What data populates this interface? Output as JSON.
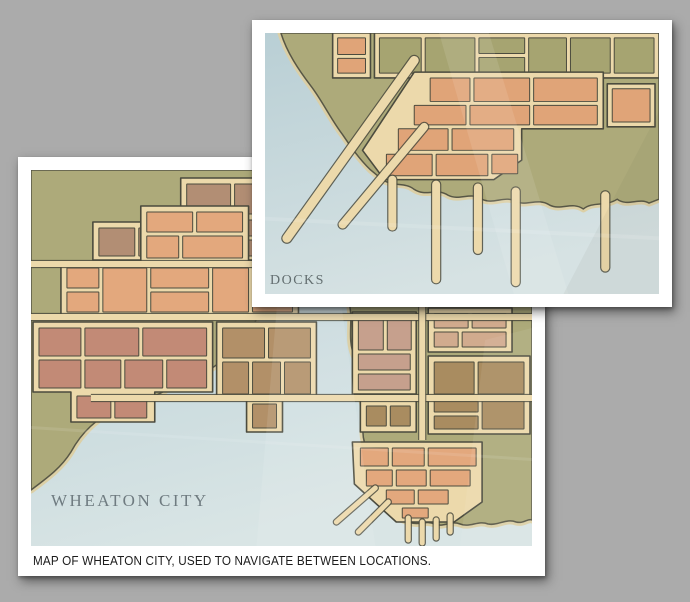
{
  "background_color": "#ababab",
  "palette": {
    "street": "#ecd9ab",
    "sand_halo": "#dccfa2",
    "outline": "#4b4b3e",
    "land": "#adaa7a"
  },
  "cards": {
    "wheaton": {
      "label": "WHEATON CITY",
      "caption": "MAP OF WHEATON CITY, USED TO NAVIGATE BETWEEN LOCATIONS."
    },
    "docks": {
      "label": "DOCKS"
    }
  },
  "maps": {
    "wheaton": {
      "id": "wheaton",
      "viewBox": "0 0 502 376",
      "water_top": "#b7ced5",
      "water_bottom": "#d9e5e5",
      "land": [
        "M0,0 L247,0 C240,20 246,42 236,62 C242,84 230,104 234,126 C228,146 222,160 212,172 C200,186 186,194 174,204 C158,214 146,212 132,222 C114,232 96,230 82,240 C66,250 52,260 40,282 C30,298 16,308 0,320 Z",
        "M314,0 C320,22 312,44 322,66 C314,88 326,108 318,130 C324,150 316,168 324,186 C330,202 326,216 332,232 C336,248 330,258 334,272 C338,290 330,300 338,314 C346,330 358,340 368,348 L378,352 C390,356 396,350 404,354 C414,358 420,350 430,354 C440,358 448,350 458,354 C468,356 476,348 486,352 C494,354 498,348 502,350 L502,0 Z"
      ],
      "districts": [
        {
          "color": "#b28e74",
          "underlay": "M62,52 L150,52 L150,8 L306,8 L306,90 L62,90 Z",
          "blocks": [
            [
              156,
              14,
              44,
              30
            ],
            [
              204,
              14,
              50,
              30
            ],
            [
              258,
              14,
              42,
              30
            ],
            [
              156,
              50,
              32,
              36
            ],
            [
              192,
              50,
              46,
              16
            ],
            [
              192,
              70,
              46,
              16
            ],
            [
              242,
              50,
              28,
              36
            ],
            [
              274,
              50,
              26,
              36
            ],
            [
              68,
              58,
              36,
              28
            ],
            [
              108,
              58,
              38,
              28
            ]
          ]
        },
        {
          "color": "#e3a87d",
          "underlay": "M110,36 L218,36 L218,92 L268,92 L268,148 L30,148 L30,92 L110,92 Z",
          "blocks": [
            [
              116,
              42,
              46,
              20
            ],
            [
              166,
              42,
              46,
              20
            ],
            [
              116,
              66,
              32,
              22
            ],
            [
              152,
              66,
              60,
              22
            ],
            [
              36,
              98,
              32,
              20
            ],
            [
              36,
              122,
              32,
              20
            ],
            [
              72,
              98,
              44,
              44
            ],
            [
              120,
              98,
              58,
              20
            ],
            [
              120,
              122,
              58,
              20
            ],
            [
              182,
              98,
              36,
              44
            ],
            [
              222,
              98,
              40,
              20
            ],
            [
              222,
              122,
              40,
              20
            ]
          ]
        },
        {
          "color": "#c28a76",
          "underlay": "M2,152 L182,152 L182,222 L124,222 L124,252 L40,252 L40,222 L2,222 Z",
          "blocks": [
            [
              8,
              158,
              42,
              28
            ],
            [
              54,
              158,
              54,
              28
            ],
            [
              112,
              158,
              64,
              28
            ],
            [
              8,
              190,
              42,
              28
            ],
            [
              54,
              190,
              36,
              28
            ],
            [
              94,
              190,
              38,
              28
            ],
            [
              136,
              190,
              40,
              28
            ],
            [
              46,
              226,
              34,
              22
            ],
            [
              84,
              226,
              32,
              22
            ]
          ]
        },
        {
          "color": "#b29068",
          "underlay": "M186,152 L286,152 L286,230 L252,230 L252,262 L216,262 L216,230 L186,230 Z",
          "blocks": [
            [
              192,
              158,
              42,
              30
            ],
            [
              238,
              158,
              42,
              30
            ],
            [
              192,
              192,
              26,
              32
            ],
            [
              222,
              192,
              28,
              32
            ],
            [
              254,
              192,
              26,
              32
            ],
            [
              222,
              234,
              24,
              24
            ]
          ]
        },
        {
          "color": "#c6a08d",
          "underlay": "M322,142 L386,142 L386,224 L322,224 Z",
          "blocks": [
            [
              328,
              148,
              25,
              32
            ],
            [
              357,
              148,
              24,
              32
            ],
            [
              328,
              184,
              52,
              16
            ],
            [
              328,
              204,
              52,
              16
            ]
          ]
        },
        {
          "color": "#d1ab8e",
          "underlay": "M398,138 L482,138 L482,182 L398,182 Z",
          "blocks": [
            [
              404,
              144,
              34,
              14
            ],
            [
              442,
              144,
              34,
              14
            ],
            [
              404,
              162,
              24,
              15
            ],
            [
              432,
              162,
              44,
              15
            ]
          ]
        },
        {
          "color": "#a98c60",
          "underlay": "M398,186 L500,186 L500,264 L398,264 Z",
          "blocks": [
            [
              404,
              192,
              40,
              32
            ],
            [
              448,
              192,
              46,
              32
            ],
            [
              404,
              228,
              44,
              14
            ],
            [
              404,
              246,
              44,
              13
            ],
            [
              452,
              228,
              42,
              31
            ]
          ]
        },
        {
          "color": "#a98c60",
          "underlay": "M330,230 L386,230 L386,262 L330,262 Z",
          "blocks": [
            [
              336,
              236,
              20,
              20
            ],
            [
              360,
              236,
              20,
              20
            ]
          ]
        },
        {
          "color": "#e3a87d",
          "underlay": "M322,272 L452,272 L452,332 L424,352 L366,352 L324,314 Z",
          "blocks": [
            [
              330,
              278,
              28,
              18
            ],
            [
              362,
              278,
              32,
              18
            ],
            [
              398,
              278,
              48,
              18
            ],
            [
              336,
              300,
              26,
              16
            ],
            [
              366,
              300,
              30,
              16
            ],
            [
              400,
              300,
              40,
              16
            ],
            [
              356,
              320,
              28,
              14
            ],
            [
              388,
              320,
              30,
              14
            ],
            [
              372,
              338,
              26,
              10
            ]
          ]
        }
      ],
      "roads": [
        {
          "d": "M0,94 L312,94",
          "w": 6
        },
        {
          "d": "M0,147 L502,147",
          "w": 6
        },
        {
          "d": "M60,228 L502,228",
          "w": 6
        },
        {
          "d": "M392,136 L392,270",
          "w": 6
        }
      ],
      "piers": [
        {
          "d": "M345,318 L306,352",
          "w": 5
        },
        {
          "d": "M358,332 L328,362",
          "w": 5
        },
        {
          "d": "M378,348 L378,370",
          "w": 5
        },
        {
          "d": "M392,352 L392,373",
          "w": 5
        },
        {
          "d": "M406,350 L406,368",
          "w": 5
        },
        {
          "d": "M420,346 L420,362",
          "w": 5
        }
      ],
      "creases": [
        {
          "d": "M258,0 L292,0 L345,376 L226,376 Z",
          "fill": "#ffffff",
          "opacity": 0.1
        },
        {
          "d": "M455,170 L502,158 L502,376 L430,376 Z",
          "fill": "#ffffff",
          "opacity": 0.07
        },
        {
          "d": "M0,256 L502,288 L502,291 L0,259 Z",
          "fill": "#ffffff",
          "opacity": 0.1
        }
      ]
    },
    "docks": {
      "id": "docks",
      "viewBox": "0 0 396 267",
      "water_top": "#b9cfd5",
      "water_bottom": "#d6e2e3",
      "land": [
        "M16,0 C22,20 34,38 46,54 C58,70 66,88 78,104 C86,116 94,128 106,140 L118,150 C130,158 140,152 150,160 C162,168 172,158 184,166 C196,172 206,162 218,170 C230,176 240,166 252,172 C262,178 274,168 286,176 C298,182 308,172 320,180 C330,172 342,178 354,170 C364,178 376,168 386,174 L396,170 L396,0 Z"
      ],
      "districts": [
        {
          "color": "#e0a478",
          "underlay": "M68,0 L106,0 L106,46 L68,46 Z",
          "blocks": [
            [
              73,
              5,
              28,
              17
            ],
            [
              73,
              26,
              28,
              15
            ]
          ]
        },
        {
          "color": "#a6a471",
          "underlay": "M110,0 L396,0 L396,46 L110,46 Z",
          "blocks": [
            [
              115,
              5,
              42,
              36
            ],
            [
              161,
              5,
              50,
              36
            ],
            [
              215,
              5,
              46,
              16
            ],
            [
              215,
              25,
              46,
              16
            ],
            [
              265,
              5,
              38,
              36
            ],
            [
              307,
              5,
              40,
              36
            ],
            [
              351,
              5,
              40,
              36
            ]
          ]
        },
        {
          "color": "#e0a478",
          "underlay": "M150,40 L340,40 L340,98 L258,98 L258,130 L230,150 L120,150 L98,120 Z",
          "blocks": [
            [
              166,
              46,
              40,
              24
            ],
            [
              210,
              46,
              56,
              24
            ],
            [
              270,
              46,
              64,
              24
            ],
            [
              150,
              74,
              52,
              20
            ],
            [
              206,
              74,
              60,
              20
            ],
            [
              270,
              74,
              64,
              20
            ],
            [
              134,
              98,
              50,
              22
            ],
            [
              188,
              98,
              62,
              22
            ],
            [
              122,
              124,
              46,
              22
            ],
            [
              172,
              124,
              52,
              22
            ],
            [
              228,
              124,
              26,
              20
            ]
          ]
        },
        {
          "color": "#e0a478",
          "underlay": "M344,52 L392,52 L392,96 L344,96 Z",
          "blocks": [
            [
              349,
              57,
              38,
              34
            ]
          ]
        }
      ],
      "roads": [],
      "piers": [
        {
          "d": "M150,28 L22,210",
          "w": 9
        },
        {
          "d": "M160,96 L78,196",
          "w": 8
        },
        {
          "d": "M128,150 L128,198",
          "w": 8
        },
        {
          "d": "M172,155 L172,252",
          "w": 8
        },
        {
          "d": "M214,158 L214,222",
          "w": 8
        },
        {
          "d": "M252,162 L252,255",
          "w": 8
        },
        {
          "d": "M342,166 L342,240",
          "w": 8
        }
      ],
      "creases": [
        {
          "d": "M175,0 L225,0 L305,267 L250,267 Z",
          "fill": "#ffffff",
          "opacity": 0.1
        },
        {
          "d": "M300,267 L396,80 L396,267 Z",
          "fill": "#50503f",
          "opacity": 0.06
        },
        {
          "d": "M0,188 L396,208 L396,212 L0,192 Z",
          "fill": "#ffffff",
          "opacity": 0.12
        }
      ]
    }
  }
}
